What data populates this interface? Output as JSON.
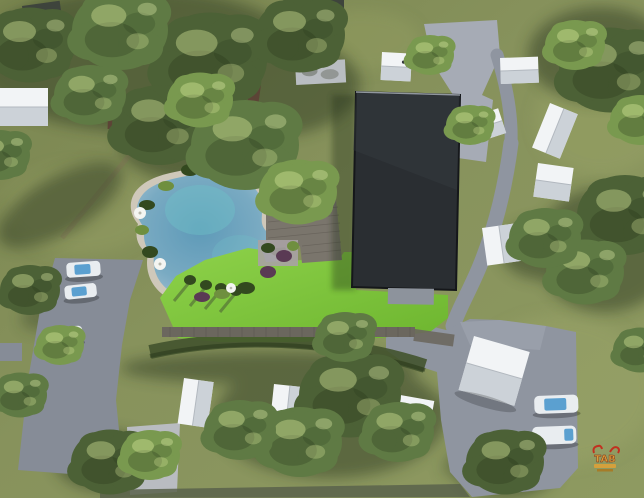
{
  "scene": {
    "title": "Aerial 3D site plan rendering of a wooded resort campground",
    "watermark": {
      "text": "TAB"
    },
    "inventory": {
      "main_building": 1,
      "swimming_pond": 1,
      "wooden_deck": 1,
      "boardwalk": 1,
      "white_cabins": 11,
      "dark_shed": 1,
      "gray_tent": 1,
      "cars_left_parking": 3,
      "cars_right_road": 2,
      "parking_lots": 2,
      "roads": 3,
      "umbrellas": 3
    }
  },
  "colors": {
    "grassBase": "#86915c",
    "grassDeep": "#707d4c",
    "grassLight": "#9aa468",
    "lawn": "#7fc73e",
    "lawnLight": "#8ed24a",
    "pondEdge": "#aac6d6",
    "pondDeep": "#5e9ab8",
    "pondTeal": "#6fc0c8",
    "sand": "#cfc8ba",
    "road": "#8f95a0",
    "pavement": "#a6abb5",
    "parking": "#868c97",
    "pad": "#b9bcc1",
    "building": "#2a2e32",
    "buildingEdge": "#90969e",
    "terrace": "#8d939c",
    "deck": "#7a756c",
    "boardwalk": "#6b675e",
    "cabin": "#f2f4f6",
    "shed": "#3e443c",
    "tent": "#b9bdc2",
    "hedge": "#43532e",
    "treeDark": "#4c6136",
    "treeMain": "#5f7a44",
    "treeLight": "#79994f",
    "shadow": "#2e3a24",
    "wall": "#5c4436",
    "carBody": "#e9edf0",
    "carGlass": "#5ba0d0",
    "bottomRoad": "#59614b",
    "dirt": "#8a7f5c",
    "wmRed": "#c2301f",
    "wmGold": "#d8a03a"
  }
}
